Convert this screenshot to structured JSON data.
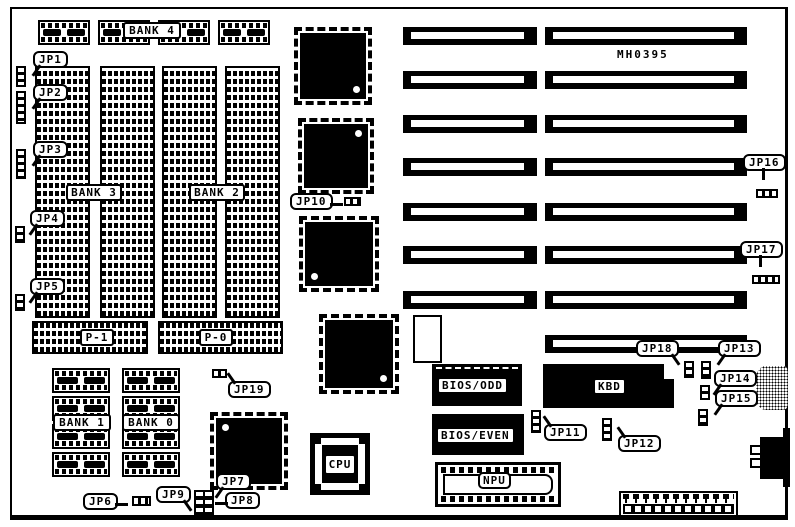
{
  "board": {
    "part_number": "MH0395"
  },
  "memory": {
    "bank4": "BANK 4",
    "bank3": "BANK 3",
    "bank2": "BANK 2",
    "bank1": "BANK 1",
    "bank0": "BANK 0",
    "p1": "P-1",
    "p0": "P-0"
  },
  "chips": {
    "bios_odd": "BIOS/ODD",
    "bios_even": "BIOS/EVEN",
    "kbd": "KBD",
    "npu": "NPU",
    "cpu": "CPU"
  },
  "jumpers": {
    "jp1": "JP1",
    "jp2": "JP2",
    "jp3": "JP3",
    "jp4": "JP4",
    "jp5": "JP5",
    "jp6": "JP6",
    "jp7": "JP7",
    "jp8": "JP8",
    "jp9": "JP9",
    "jp10": "JP10",
    "jp11": "JP11",
    "jp12": "JP12",
    "jp13": "JP13",
    "jp14": "JP14",
    "jp15": "JP15",
    "jp16": "JP16",
    "jp17": "JP17",
    "jp18": "JP18",
    "jp19": "JP19"
  }
}
